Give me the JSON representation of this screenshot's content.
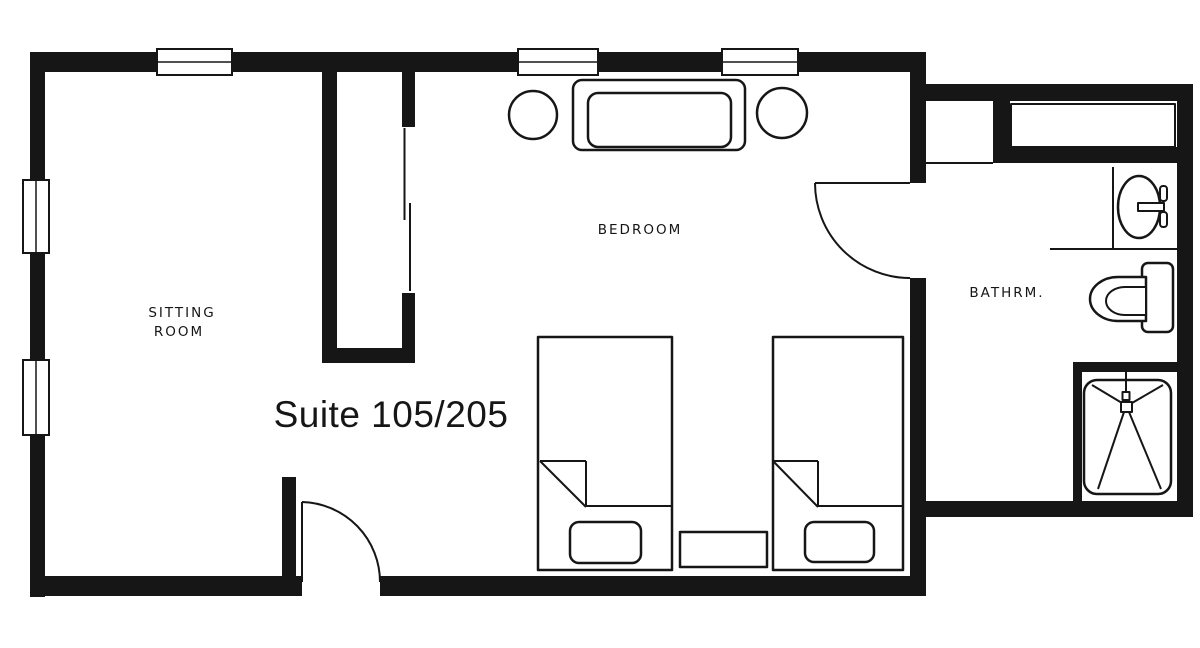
{
  "page": {
    "background": "#ffffff"
  },
  "colors": {
    "ink": "#161616",
    "paper": "#ffffff"
  },
  "title": {
    "label": "Suite 105/205"
  },
  "rooms": {
    "sitting": {
      "label_line1": "SITTING",
      "label_line2": "ROOM"
    },
    "bedroom": {
      "label": "BEDROOM"
    },
    "bathroom": {
      "label": "BATHRM."
    }
  },
  "symbols": [
    "window-symbol",
    "door-swing-symbol",
    "sliding-door-symbol",
    "sofa-icon",
    "round-side-table-icon",
    "twin-bed-icon",
    "blanket-fold-symbol",
    "bed-bench-icon",
    "nightstand-icon",
    "closet-shelf-icon",
    "sink-vanity-icon",
    "toilet-icon",
    "shower-icon"
  ]
}
